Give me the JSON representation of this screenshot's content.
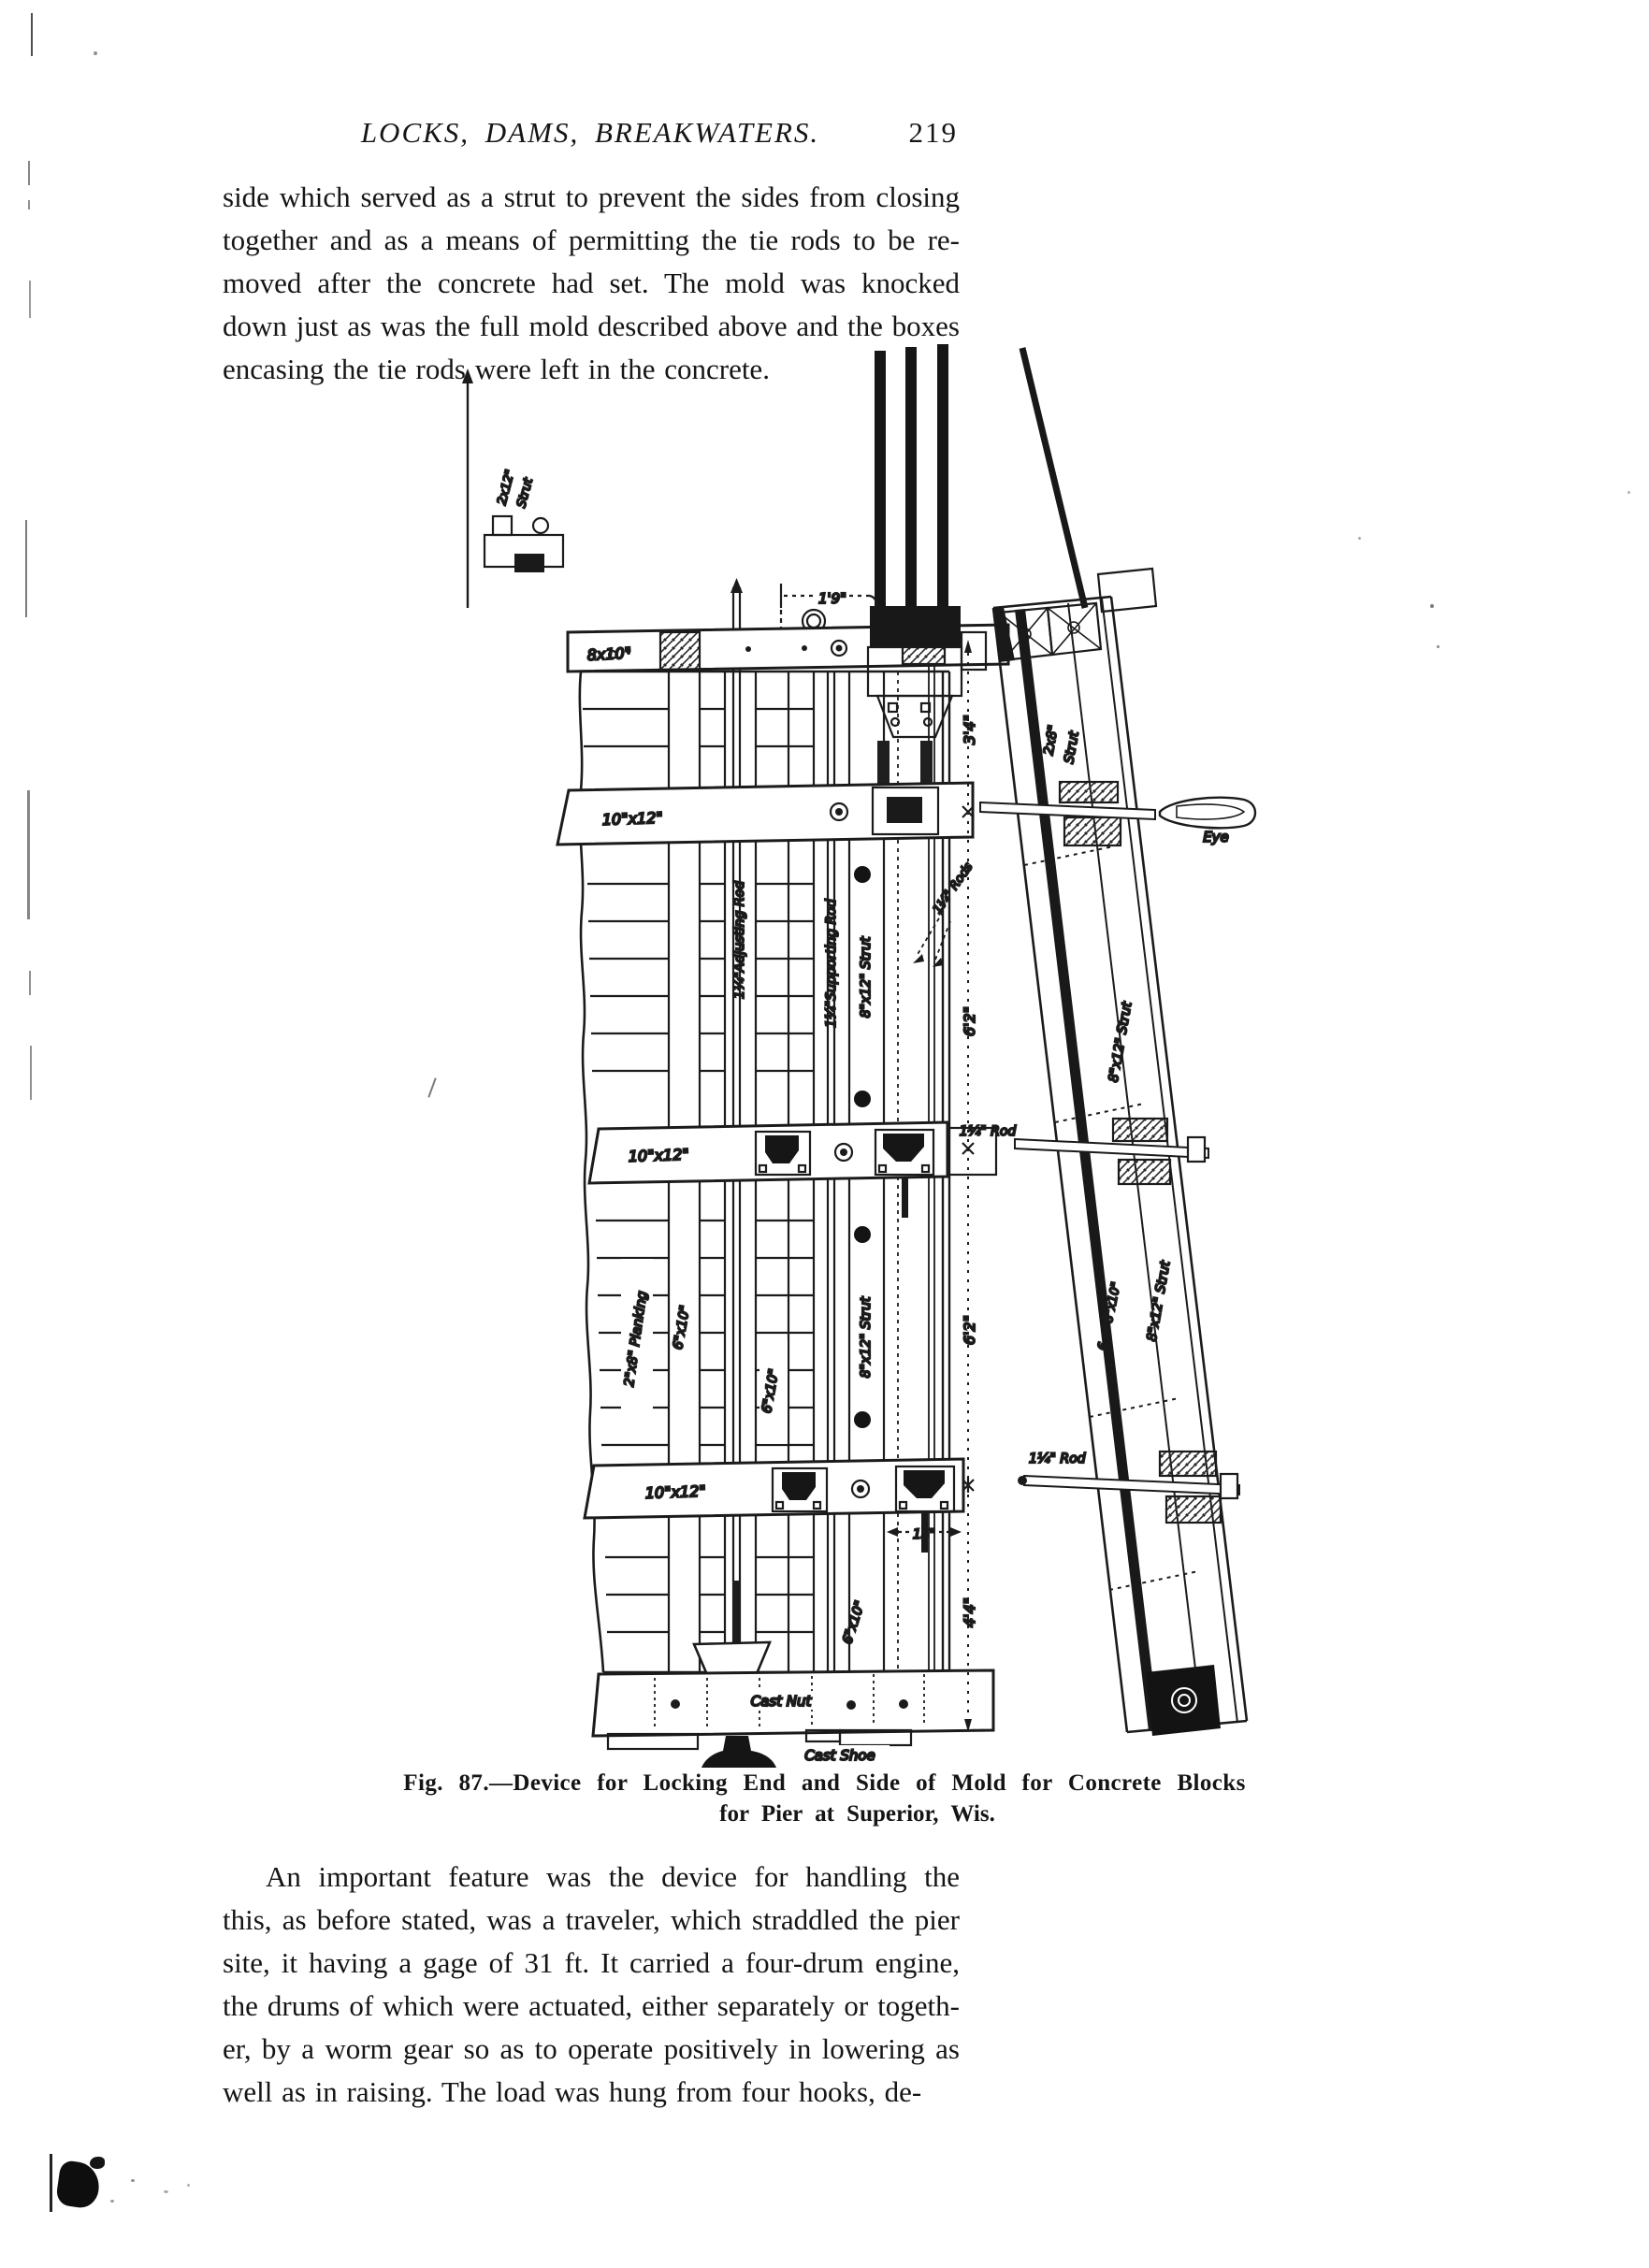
{
  "header": {
    "title": "LOCKS, DAMS, BREAKWATERS.",
    "page_number": "219"
  },
  "paragraph1": {
    "lines": [
      "side which served as a strut to prevent the sides from closing",
      "together and as a means of permitting the tie rods to be re-",
      "moved after the concrete had set. The mold was knocked",
      "down just as was the full mold described above and the boxes",
      "encasing the tie rods were left in the concrete."
    ]
  },
  "figure": {
    "caption_line1": "Fig. 87.—Device for Locking End and Side of Mold for Concrete Blocks",
    "caption_line2": "for Pier at Superior, Wis.",
    "labels": {
      "dim_1_9": "1'9\"",
      "beam_8x10": "8x10\"",
      "strut_2x12_a": "2x12\"",
      "strut_2x12_b": "Strut",
      "waler_10x12": "10\"x12\"",
      "strut_2x8_a": "2x8\"",
      "strut_2x8_b": "Strut",
      "eye": "Eye",
      "dim_3_4": "3'4\"",
      "adjusting_rod": "1¼\"Adjusting Rod",
      "supporting_rod": "1¼\"Supporting Rod",
      "strut_8x12": "8\"x12\" Strut",
      "rods": "1¼\" Rods",
      "dim_6_2": "6'2\"",
      "rod": "1¼\" Rod",
      "strut_6or8": "6 or 8\"x10\"",
      "planking": "2\"x8\" Planking",
      "s6x10": "6\"x10\"",
      "dim_15": "15\"",
      "dim_4_4": "4'4\"",
      "cast_nut": "Cast Nut",
      "cast_shoe": "Cast Shoe"
    }
  },
  "paragraph2": {
    "lines": [
      "An important feature was the device for handling the molds;",
      "this, as before stated, was a traveler, which straddled the pier",
      "site, it having a gage of 31 ft. It carried a four-drum engine,",
      "the drums of which were actuated, either separately or togeth-",
      "er, by a worm gear so as to operate positively in lowering as",
      "well as in raising. The load was hung from four hooks, de-"
    ]
  }
}
